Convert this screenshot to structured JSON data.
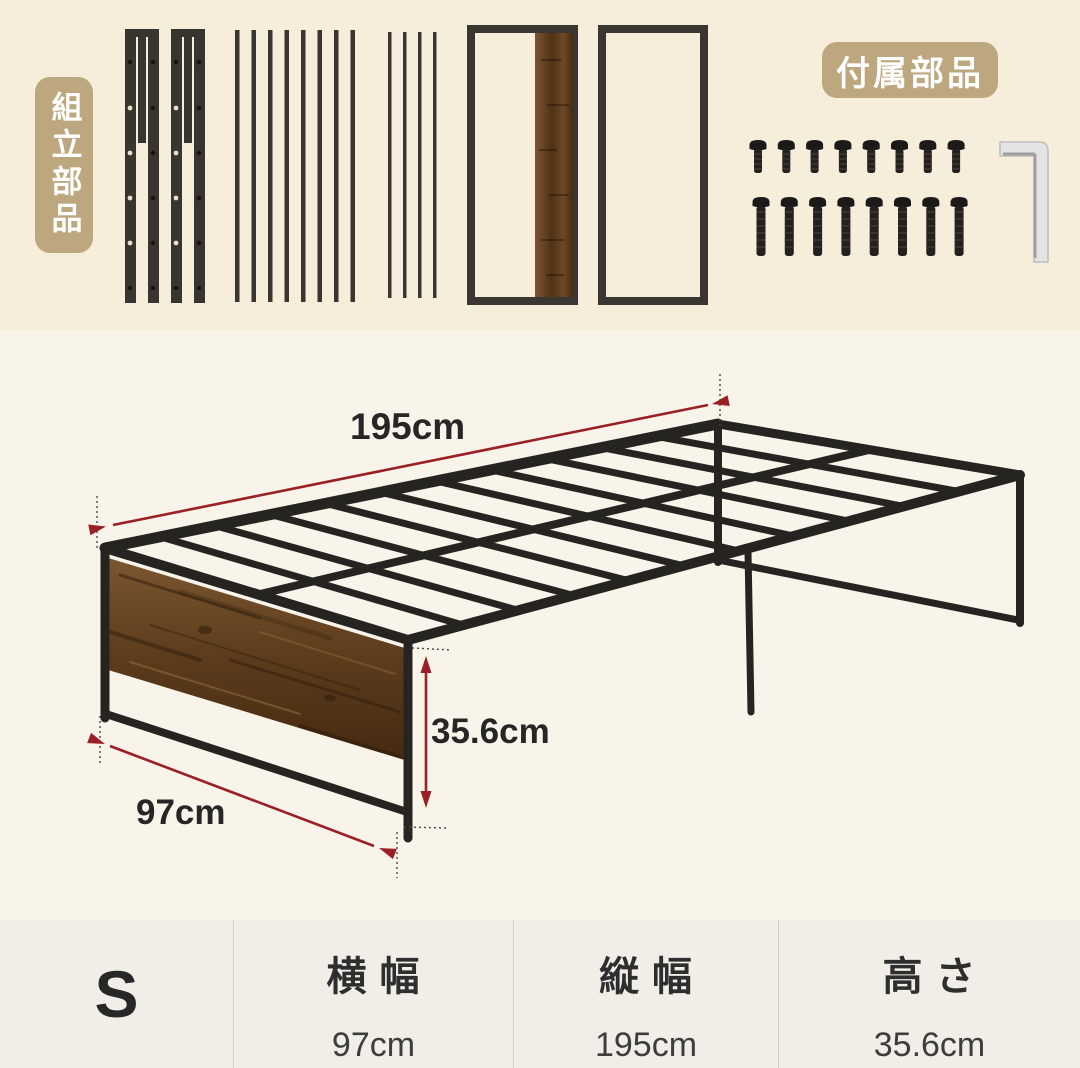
{
  "parts_section": {
    "assembly_label": "組立部品",
    "included_label": "付属部品",
    "label_bg": "#bda77e",
    "label_text_color": "#ffffff",
    "pieces": [
      {
        "name": "side-rail-with-holes",
        "count": 2
      },
      {
        "name": "wide-slat",
        "count": 8
      },
      {
        "name": "narrow-slat",
        "count": 4
      },
      {
        "name": "headboard-frame-with-wood-panel",
        "count": 1
      },
      {
        "name": "footboard-frame",
        "count": 1
      }
    ],
    "hardware": {
      "short_screws": 8,
      "long_screws": 8,
      "hex_wrench": 1
    }
  },
  "diagram": {
    "length": "195cm",
    "width": "97cm",
    "height": "35.6cm",
    "arrow_color": "#9a2025",
    "frame_color": "#262421",
    "wood_color": "#6e4a24"
  },
  "spec_table": {
    "size": "S",
    "columns": [
      {
        "label": "横 幅",
        "value": "97cm"
      },
      {
        "label": "縦 幅",
        "value": "195cm"
      },
      {
        "label": "高 さ",
        "value": "35.6cm"
      }
    ]
  }
}
